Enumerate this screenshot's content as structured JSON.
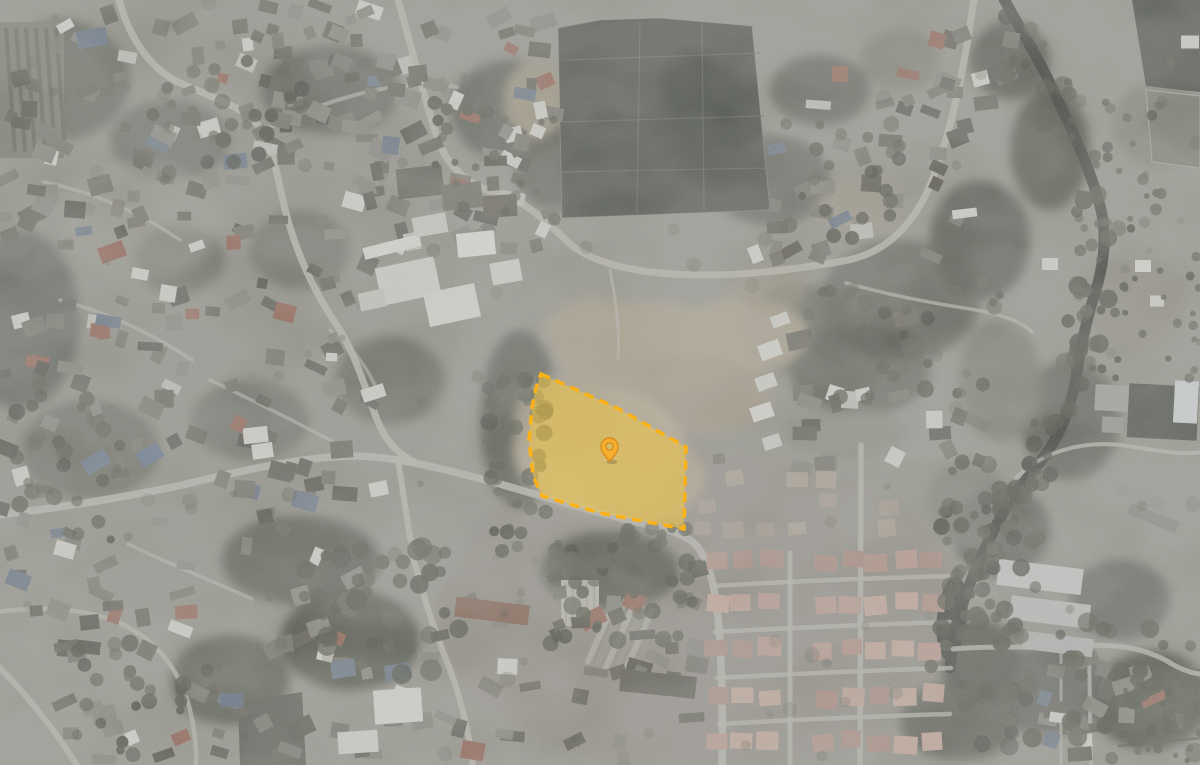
{
  "map": {
    "kind": "satellite-aerial-photo",
    "base_tone": "#8f8e87"
  },
  "parcel": {
    "points": "541,374 617,408 686,447 684,529 600,513 542,496 533,476 529,440 532,407 536,388",
    "fill": "#F6C83F",
    "fill_opacity": "0.52",
    "stroke": "#FCB216",
    "stroke_width": "3.5",
    "dash": "9.5 6.5"
  },
  "marker": {
    "transform": "translate(609.5,446.5)",
    "fill": "#F5AE2D",
    "stroke": "#D4881C"
  }
}
